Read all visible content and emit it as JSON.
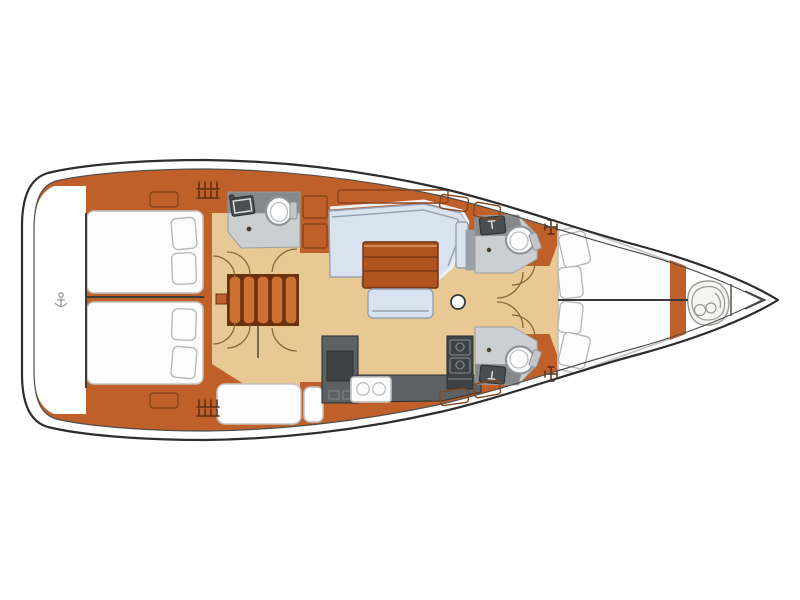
{
  "diagram": {
    "type": "boat-floor-plan",
    "subject": "sailing-yacht-interior-layout",
    "orientation": "bow-right-stern-left",
    "rooms": [
      "swim-platform",
      "aft-cabin-port",
      "aft-cabin-starboard",
      "aft-head-port",
      "companionway-stairs",
      "side-berth",
      "salon-settee",
      "salon-table",
      "salon-bench",
      "galley",
      "forward-head-port",
      "forward-head-starboard",
      "corridor",
      "owner-cabin-vberth",
      "anchor-locker"
    ]
  },
  "icons": {
    "toilet": "toilet-icon",
    "sink": "sink-icon",
    "stove": "stove-icon",
    "mast_post": "mast-post-icon",
    "anchor_windlass": "anchor-windlass-sketch-icon",
    "stern_fitting": "stern-fitting-icon",
    "deck_vent": "vent-grate-icon",
    "cleat": "cleat-cross-icon"
  },
  "colors": {
    "white": "#ffffff",
    "hull_outline": "#2d2d2d",
    "inner_line": "#4f4f4f",
    "centerline": "#3a3a3a",
    "wood": "#bf5f2a",
    "wood_dark": "#8a4518",
    "wood_darker": "#6b3211",
    "wood_light": "#cc7034",
    "table_wood": "#b0541e",
    "table_hi": "#d08a54",
    "floor_tan": "#e8c893",
    "settee_blue": "#d9e2ef",
    "settee_outline": "#96a1b3",
    "settee_rim": "#eef2f8",
    "bed_white": "#fcfcfc",
    "bed_outline": "#c2c2c2",
    "pillow_outline": "#b5b5b5",
    "head_floor": "#cbcfd2",
    "head_counter": "#85898c",
    "head_edge": "#9a9ea0",
    "arm_gray": "#9aa0a8",
    "fixture_dark": "#4a4e50",
    "fixture_edge": "#2e3234",
    "fixture_hi": "#d8dcde",
    "galley_counter": "#5d6163",
    "galley_dark": "#3e4244",
    "galley_edge": "#2f3335",
    "galley_hi": "#7b7f81",
    "toilet_ring": "#8f9598",
    "toilet_ring2": "#b9bfc2",
    "cistern": "#c3c7c9",
    "door_arc": "#8a6a3c",
    "knob": "#4a3f2f",
    "sketch": "#9a9a94",
    "sketch_fill": "#f4f4f2",
    "glyph": "#5e2d10"
  }
}
